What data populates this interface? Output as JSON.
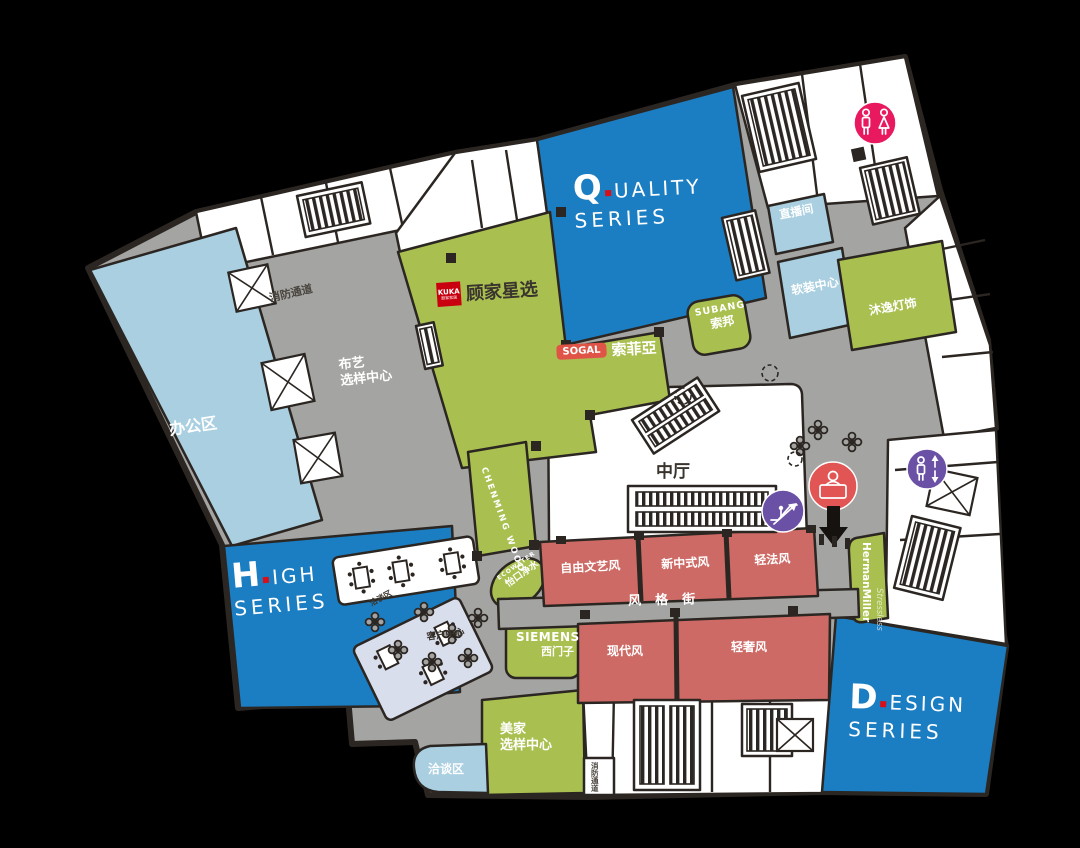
{
  "canvas": {
    "bg": "#000000"
  },
  "palette": {
    "blue": "#1b7dc2",
    "light_blue": "#a9cfe1",
    "lavender": "#d9deed",
    "green": "#a9c050",
    "salmon": "#cd6a65",
    "gray": "#a4a4a2",
    "dark": "#2b2622",
    "white": "#ffffff",
    "pink": "#e9195f",
    "purple": "#6b51a5",
    "info_red": "#e15654",
    "logo_red": "#c8000f",
    "sogal_red": "#e05448"
  },
  "series": {
    "quality": {
      "initial": "Q",
      "rest": "UALITY",
      "line2": "SERIES"
    },
    "high": {
      "initial": "H",
      "rest": "IGH",
      "line2": "SERIES"
    },
    "design": {
      "initial": "D",
      "rest": "ESIGN",
      "line2": "SERIES"
    }
  },
  "zones": {
    "office": "办公区",
    "atrium": "中厅",
    "style_street": "风格街",
    "fabric_center_line1": "布艺",
    "fabric_center_line2": "选样中心",
    "fire_passage": "消防通道",
    "fire_passage_south": "消防通道",
    "live_room": "直播间",
    "soft_deco_center": "软装中心",
    "muyi_lighting": "沐逸灯饰",
    "customer_center": "客户中心",
    "lounge_mid": "洽谈区",
    "lounge_south": "洽谈区",
    "home_sample_line1": "美家",
    "home_sample_line2": "选样中心"
  },
  "style_rooms": {
    "north": [
      "自由文艺风",
      "新中式风",
      "轻法风"
    ],
    "south": [
      "现代风",
      "轻奢风"
    ]
  },
  "brands": {
    "kuka": {
      "logo_line1": "KUKA",
      "logo_line2": "顾家家居",
      "name": "顾家星选"
    },
    "sogal": {
      "logo": "SOGAL",
      "name": "索菲亞"
    },
    "subang": {
      "en": "SUBANG",
      "cn": "索邦"
    },
    "siemens": {
      "en": "SIEMENS",
      "cn": "西门子"
    },
    "chenming": {
      "en": "CHENMING WOOD"
    },
    "ecowater": {
      "en": "ECOWATER",
      "cn": "怡口净水"
    },
    "herman_miller": {
      "en": "HermanMiller",
      "sub": "Stressless"
    }
  },
  "icons": {
    "restroom": "restroom-icon",
    "escalator": "escalator-icon",
    "elevator": "elevator-icon",
    "information": "information-icon",
    "down_arrow": "down-arrow-icon"
  }
}
